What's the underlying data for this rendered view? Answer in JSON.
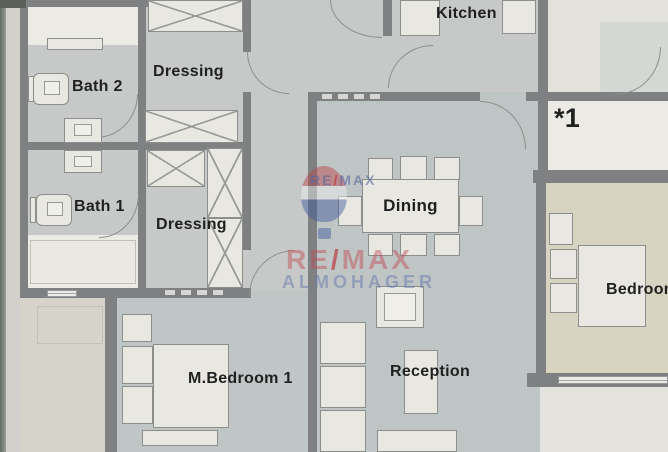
{
  "plan": {
    "type": "apartment-floor-plan",
    "rooms": [
      {
        "name": "kitchen",
        "label": "Kitchen"
      },
      {
        "name": "bath_2",
        "label": "Bath 2"
      },
      {
        "name": "dressing_top",
        "label": "Dressing"
      },
      {
        "name": "bath_1",
        "label": "Bath 1"
      },
      {
        "name": "dressing_mid",
        "label": "Dressing"
      },
      {
        "name": "dining",
        "label": "Dining"
      },
      {
        "name": "master_bedroom",
        "label": "M.Bedroom 1"
      },
      {
        "name": "reception",
        "label": "Reception"
      },
      {
        "name": "bedroom",
        "label": "Bedroom"
      },
      {
        "name": "unit_marker",
        "label": "*1"
      }
    ]
  },
  "watermark": {
    "small_brand": {
      "re": "RE",
      "slash": "/",
      "max": "MAX"
    },
    "large_brand": {
      "re": "RE",
      "slash": "/",
      "max": "MAX"
    },
    "agency": "ALMOHAGER"
  },
  "colors": {
    "wall": "#7f8184",
    "floor_gray": "#c9cccb",
    "floor_dining": "#c2c7c9",
    "floor_white": "#f0efeb",
    "floor_bedroom_beige": "#dbd7c5",
    "paper": "#e9e8e4",
    "brand_red": "#c0392b",
    "brand_blue": "#3a5ba8",
    "label_text": "#1d1d1f"
  }
}
